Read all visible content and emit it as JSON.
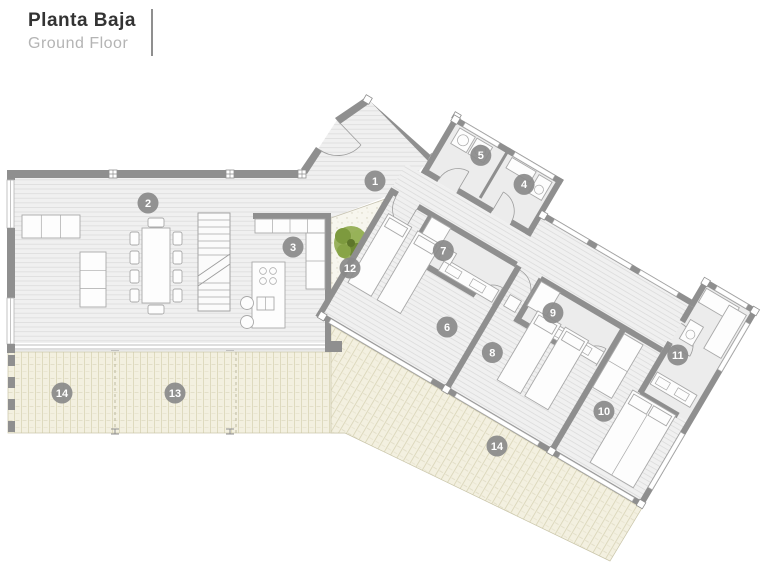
{
  "header": {
    "title": "Planta Baja",
    "subtitle": "Ground Floor"
  },
  "colors": {
    "wall": "#8f8f8f",
    "badge": "#8a8a8a",
    "badge_text": "#ffffff",
    "floor": "#f0f0f0",
    "floor_line": "#dcdcdc",
    "deck": "#f3f0e0",
    "deck_line": "#d8d4b6",
    "courtyard": "#f7f6ee",
    "tree": "#7d9a3e"
  },
  "room_badges": [
    {
      "number": "1",
      "frame": "global",
      "x": 375,
      "y": 181
    },
    {
      "number": "2",
      "frame": "global",
      "x": 148,
      "y": 203
    },
    {
      "number": "3",
      "frame": "global",
      "x": 293,
      "y": 247
    },
    {
      "number": "12",
      "frame": "global",
      "x": 350,
      "y": 268
    },
    {
      "number": "13",
      "frame": "global",
      "x": 175,
      "y": 393
    },
    {
      "number": "14",
      "frame": "global",
      "x": 62,
      "y": 393
    },
    {
      "number": "14",
      "frame": "global",
      "x": 497,
      "y": 446
    },
    {
      "number": "5",
      "frame": "wing",
      "x": 40,
      "y": 21
    },
    {
      "number": "4",
      "frame": "wing",
      "x": 92,
      "y": 24
    },
    {
      "number": "7",
      "frame": "wing",
      "x": 56,
      "y": 122
    },
    {
      "number": "9",
      "frame": "wing",
      "x": 182,
      "y": 120
    },
    {
      "number": "6",
      "frame": "wing",
      "x": 98,
      "y": 186
    },
    {
      "number": "8",
      "frame": "wing",
      "x": 150,
      "y": 185
    },
    {
      "number": "10",
      "frame": "wing",
      "x": 276,
      "y": 179
    },
    {
      "number": "11",
      "frame": "wing",
      "x": 311,
      "y": 93
    }
  ],
  "wing_transform": {
    "tx": 457,
    "ty": 117,
    "angle_deg": 30.5
  }
}
